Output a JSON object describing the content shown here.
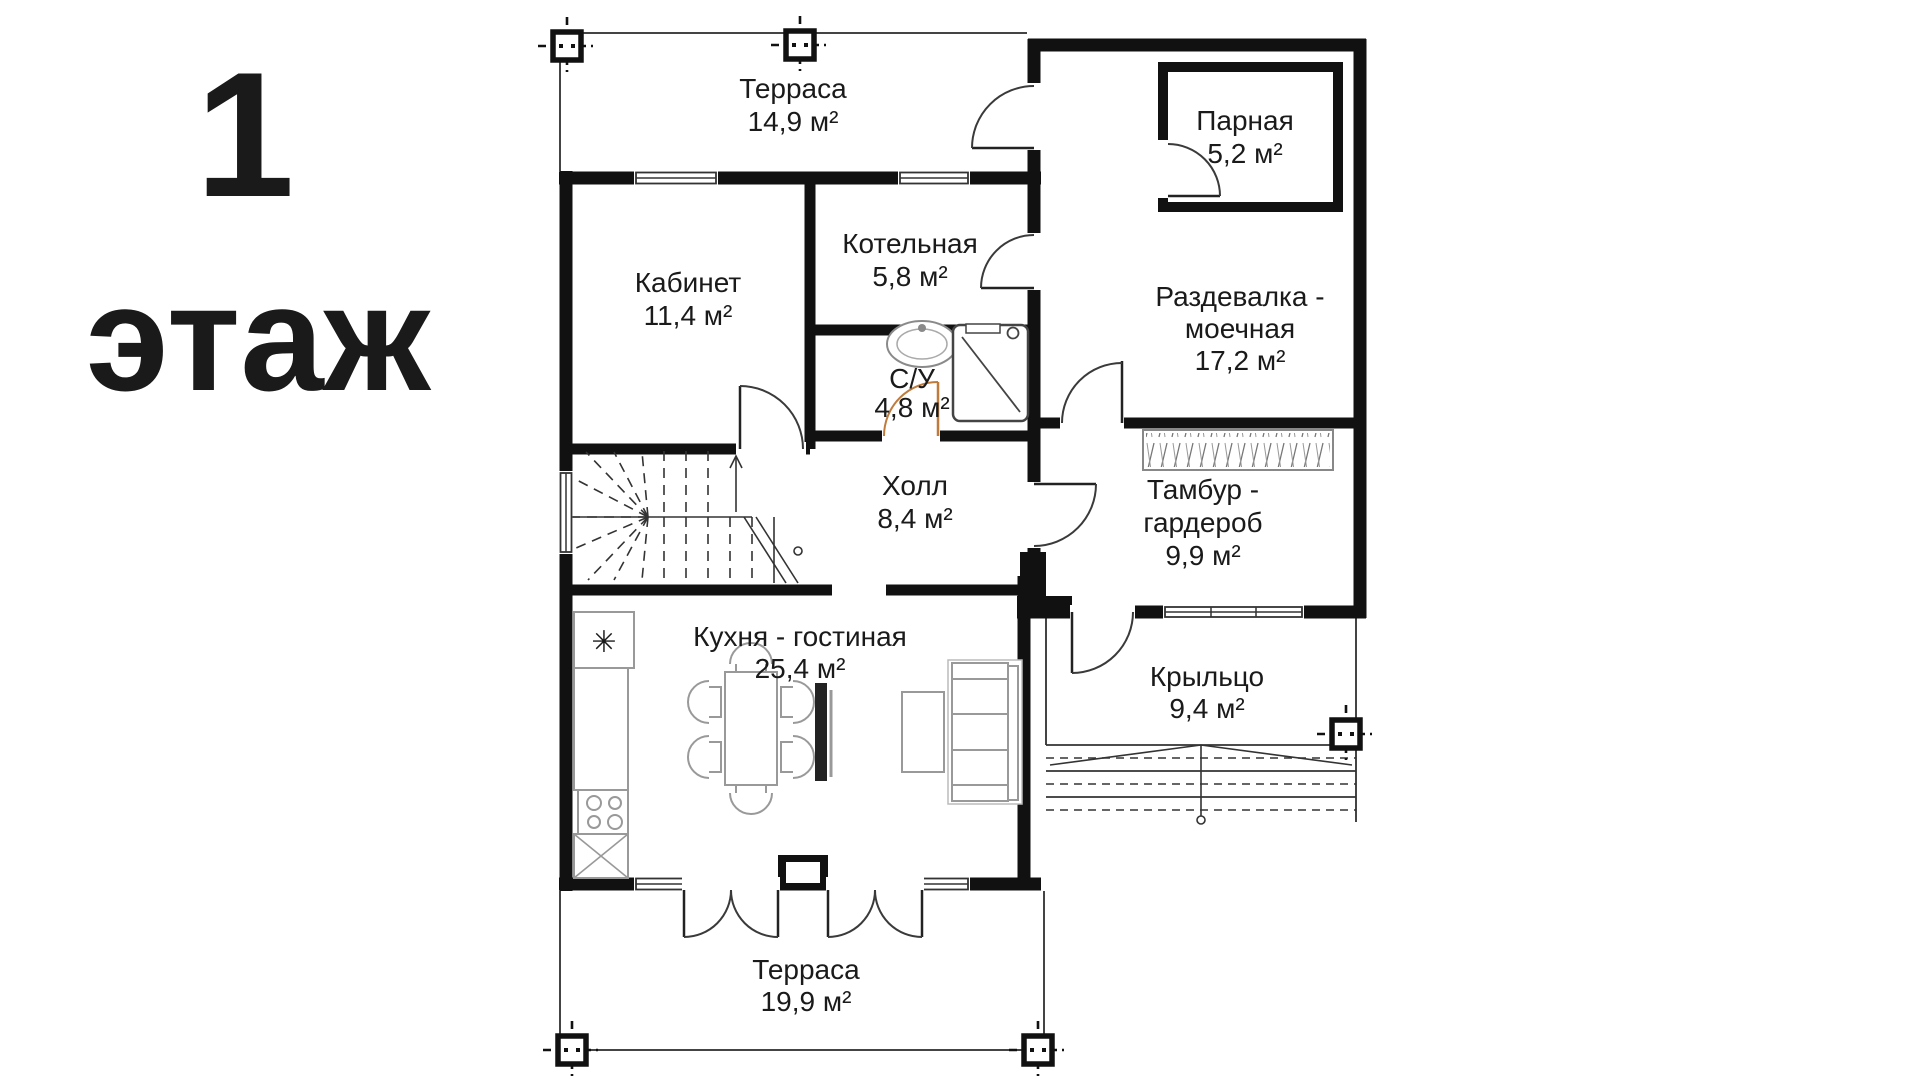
{
  "page": {
    "background": "#ffffff",
    "type": "floor-plan-drawing"
  },
  "floor_label": {
    "number": "1",
    "word": "этаж"
  },
  "rooms": {
    "terrace_top": {
      "name": "Терраса",
      "area": "14,9 м²"
    },
    "steam_room": {
      "name": "Парная",
      "area": "5,2 м²"
    },
    "office": {
      "name": "Кабинет",
      "area": "11,4 м²"
    },
    "boiler_room": {
      "name": "Котельная",
      "area": "5,8 м²"
    },
    "bathroom": {
      "name": "С/У",
      "area": "4,8 м²"
    },
    "changing_room": {
      "name_line1": "Раздевалка -",
      "name_line2": "моечная",
      "area": "17,2 м²"
    },
    "hall": {
      "name": "Холл",
      "area": "8,4 м²"
    },
    "vestibule": {
      "name_line1": "Тамбур -",
      "name_line2": "гардероб",
      "area": "9,9 м²"
    },
    "kitchen_living": {
      "name": "Кухня - гостиная",
      "area": "25,4 м²"
    },
    "porch": {
      "name": "Крыльцо",
      "area": "9,4 м²"
    },
    "terrace_bottom": {
      "name": "Терраса",
      "area": "19,9 м²"
    }
  },
  "icons": {
    "fridge_snowflake": "✳"
  },
  "colors": {
    "walls": "#111111",
    "door_arc": "#3a3a3a",
    "bathroom_door_arc": "#bf7b3c",
    "fixtures": "#8a8a8a",
    "text": "#1a1a1a"
  }
}
